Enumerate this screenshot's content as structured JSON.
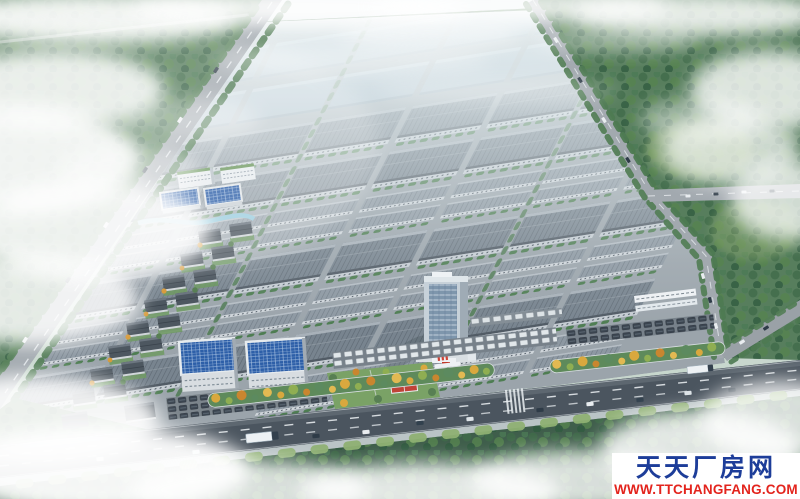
{
  "image": {
    "kind": "aerial architectural rendering",
    "subject": "industrial park master plan: rows of grey standardized factory warehouses, courtyard workshop cluster, buildings with blue solar rooftops, a glass office tower, tree-lined avenues, landscaped front boulevard with autumn trees, arterial road with vehicles, forests and low clouds"
  },
  "watermark": {
    "site_name": "天天厂房网",
    "site_url": "WWW.TTCHANGFANG.COM",
    "name_color": "#1d3d99",
    "url_color": "#e3241d",
    "background": "#ffffff"
  },
  "palette": {
    "sky_haze": "#e6eef0",
    "forest_green": "#577e5d",
    "warehouse_roof_grey": "#78848f",
    "distant_roof_blue": "#9fb2c1",
    "arterial_asphalt": "#4b555f",
    "avenue_asphalt": "#a2a9af",
    "solar_roof_blue": "#2d5fa8",
    "autumn_tree_orange": "#d9a83e",
    "accent_red": "#c0392b",
    "cloud_white": "#ffffff"
  }
}
